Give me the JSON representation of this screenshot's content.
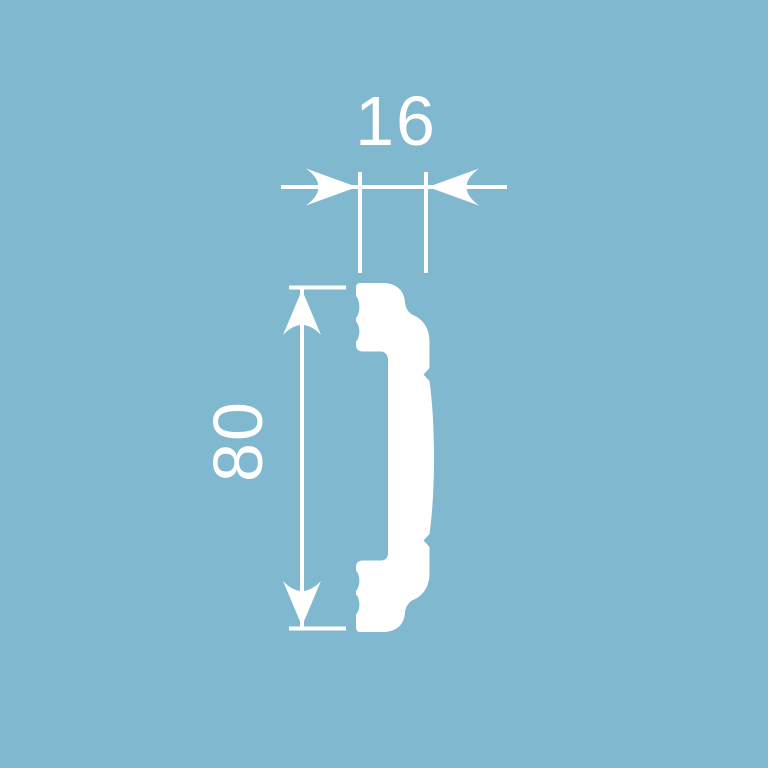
{
  "colors": {
    "background": "#80b9cf",
    "figure": "#ffffff"
  },
  "diagram": {
    "type": "technical-dimension-drawing",
    "subject": "molding-profile-cross-section",
    "dimensions": {
      "width": {
        "label": "16",
        "orientation": "horizontal",
        "position": "top"
      },
      "height": {
        "label": "80",
        "orientation": "vertical",
        "position": "left"
      }
    }
  }
}
